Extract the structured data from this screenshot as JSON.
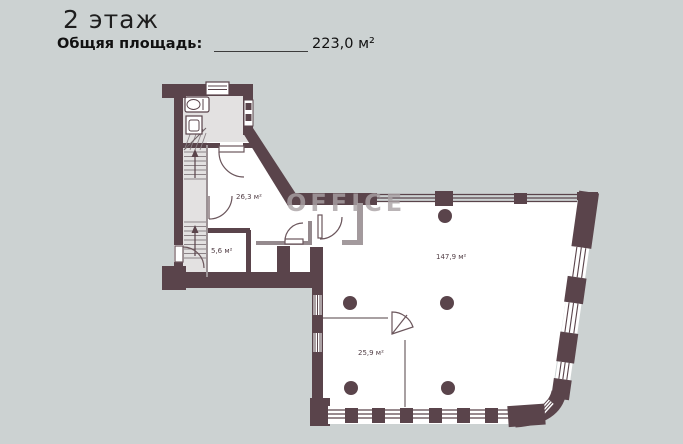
{
  "header": {
    "floor_title": "2 этаж",
    "area_label": "Общяя площадь:",
    "area_value": "223,0 м²"
  },
  "watermark": "OFFICE",
  "rooms": [
    {
      "id": "room-26-3",
      "area": "26,3 м²"
    },
    {
      "id": "room-5-6",
      "area": "5,6 м²"
    },
    {
      "id": "room-147-9",
      "area": "147,9 м²"
    },
    {
      "id": "room-25-9",
      "area": "25,9 м²"
    }
  ],
  "colors": {
    "background": "#ccd2d2",
    "wall": "#5a444b",
    "service_fill": "#e3e1e1",
    "partition": "#958a8e",
    "label_text": "#523f46",
    "watermark": "#aaa2a5"
  }
}
